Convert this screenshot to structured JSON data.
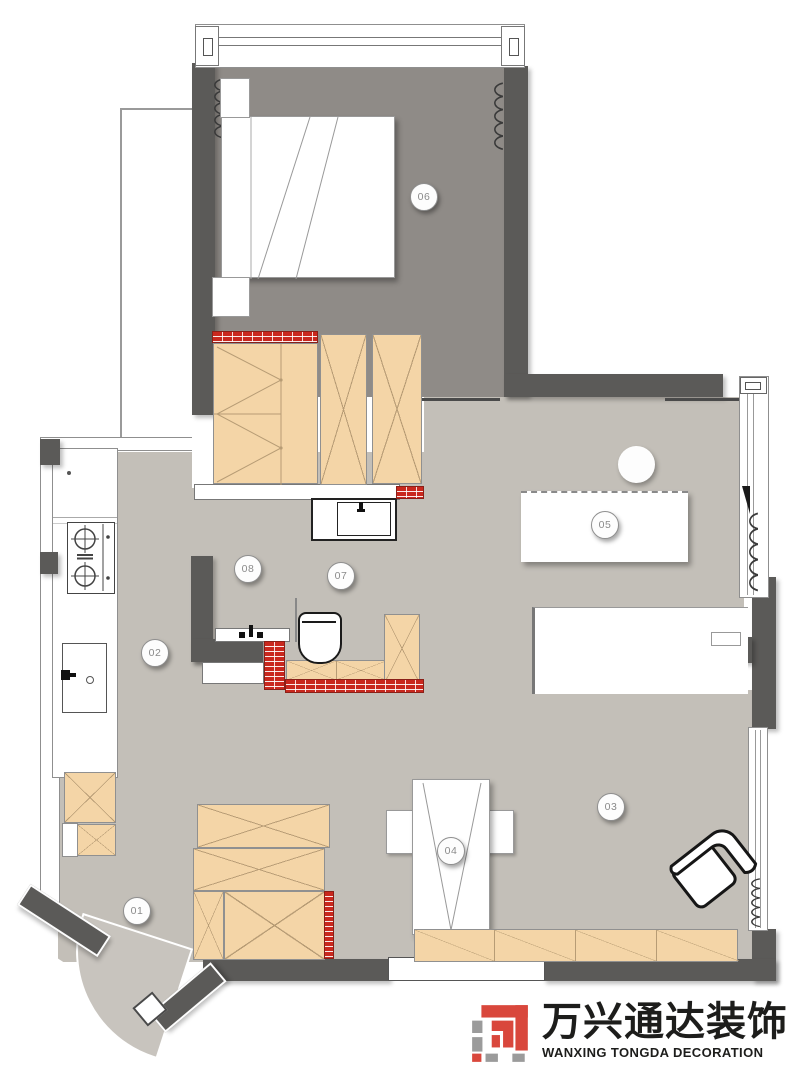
{
  "plan": {
    "type": "apartment-floor-plan",
    "rooms": [
      {
        "number": "01"
      },
      {
        "number": "02"
      },
      {
        "number": "03"
      },
      {
        "number": "04"
      },
      {
        "number": "05"
      },
      {
        "number": "06"
      },
      {
        "number": "07"
      },
      {
        "number": "08"
      }
    ]
  },
  "brand": {
    "name_zh": "万兴通达装饰",
    "name_en": "WANXING TONGDA DECORATION"
  },
  "colors": {
    "wall": "#5b5a58",
    "floor_main": "#c3bfb8",
    "floor_bedroom": "#8f8b87",
    "wood_furniture": "#f4d5a7",
    "brick_red": "#c9281e",
    "brand_red": "#d9473c",
    "brand_gray": "#9b9b9b"
  }
}
